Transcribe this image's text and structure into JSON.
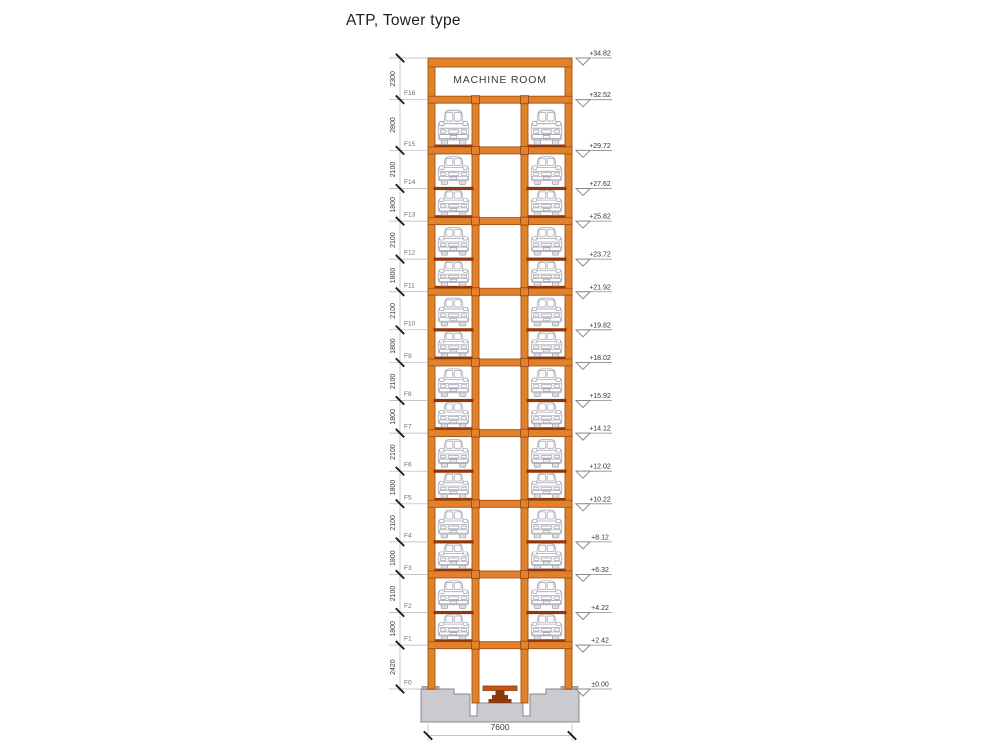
{
  "title": "ATP, Tower type",
  "machine_room_label": "MACHINE ROOM",
  "base_width_label": "7600",
  "ground_elevation_label": "±0.00",
  "floors": [
    {
      "label": "F16",
      "height_mm": 2300,
      "top_elevation": "+34.82",
      "content": "machine_room",
      "bottom_line": "beam"
    },
    {
      "label": "F15",
      "height_mm": 2800,
      "top_elevation": "+32.52",
      "content": "cars",
      "bottom_line": "beam"
    },
    {
      "label": "F14",
      "height_mm": 2100,
      "top_elevation": "+29.72",
      "content": "cars",
      "bottom_line": "platform"
    },
    {
      "label": "F13",
      "height_mm": 1800,
      "top_elevation": "+27.62",
      "content": "cars",
      "bottom_line": "beam"
    },
    {
      "label": "F12",
      "height_mm": 2100,
      "top_elevation": "+25.82",
      "content": "cars",
      "bottom_line": "platform"
    },
    {
      "label": "F11",
      "height_mm": 1800,
      "top_elevation": "+23.72",
      "content": "cars",
      "bottom_line": "beam"
    },
    {
      "label": "F10",
      "height_mm": 2100,
      "top_elevation": "+21.92",
      "content": "cars",
      "bottom_line": "platform"
    },
    {
      "label": "F9",
      "height_mm": 1800,
      "top_elevation": "+19.82",
      "content": "cars",
      "bottom_line": "beam"
    },
    {
      "label": "F8",
      "height_mm": 2100,
      "top_elevation": "+18.02",
      "content": "cars",
      "bottom_line": "platform"
    },
    {
      "label": "F7",
      "height_mm": 1800,
      "top_elevation": "+15.92",
      "content": "cars",
      "bottom_line": "beam"
    },
    {
      "label": "F6",
      "height_mm": 2100,
      "top_elevation": "+14.12",
      "content": "cars",
      "bottom_line": "platform"
    },
    {
      "label": "F5",
      "height_mm": 1800,
      "top_elevation": "+12.02",
      "content": "cars",
      "bottom_line": "beam"
    },
    {
      "label": "F4",
      "height_mm": 2100,
      "top_elevation": "+10.22",
      "content": "cars",
      "bottom_line": "platform"
    },
    {
      "label": "F3",
      "height_mm": 1800,
      "top_elevation": "+8.12",
      "content": "cars",
      "bottom_line": "beam"
    },
    {
      "label": "F2",
      "height_mm": 2100,
      "top_elevation": "+6.32",
      "content": "cars",
      "bottom_line": "platform"
    },
    {
      "label": "F1",
      "height_mm": 1800,
      "top_elevation": "+4.22",
      "content": "cars",
      "bottom_line": "beam"
    },
    {
      "label": "F0",
      "height_mm": 2420,
      "top_elevation": "+2.42",
      "content": "empty",
      "bottom_line": "none"
    }
  ],
  "colors": {
    "structure_fill": "#E0812C",
    "structure_stroke": "#A55214",
    "pallet": "#93350B",
    "node_fill": "#E08230",
    "node_stroke": "#9C4A10",
    "foundation_fill": "#CBCBCF",
    "foundation_stroke": "#87878C",
    "baseplate_fill": "#ABABB1",
    "baseplate_stroke": "#808085",
    "turntable_fill": "#C8560F",
    "turntable_dark": "#8B3A0E",
    "car_stroke": "#A7A9B3",
    "car_wheel_fill": "#DFE0E5",
    "dim_line": "#B3B3B3",
    "tick": "#1F1F1F",
    "dim_text": "#3A3A3A",
    "floor_label": "#6E6E6E",
    "elev_line": "#8A8A8A",
    "elev_text": "#333333",
    "machine_text": "#3C3C3C",
    "title_color": "#1F1F1F"
  }
}
